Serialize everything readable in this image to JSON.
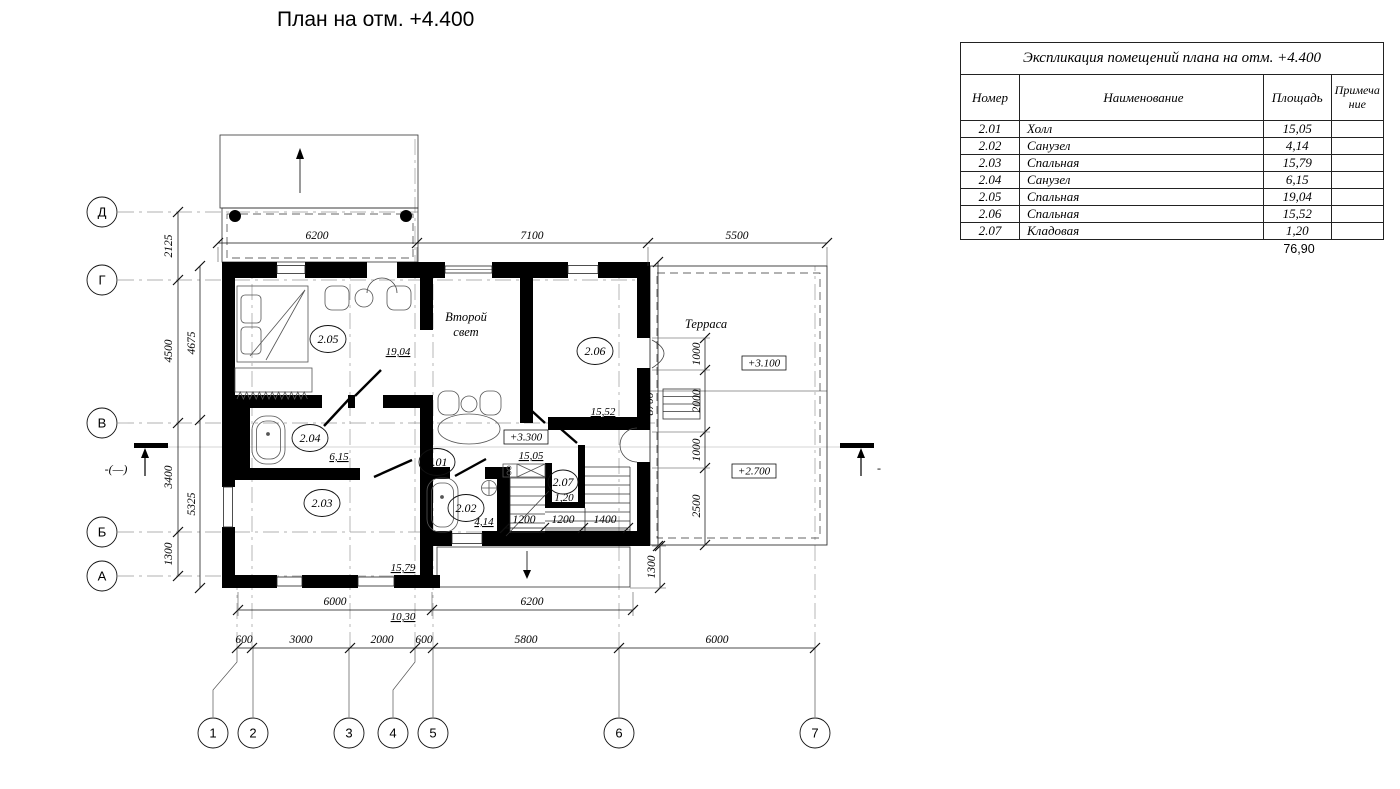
{
  "page_title": "План на отм. +4.400",
  "table": {
    "title": "Экспликация помещений плана на отм. +4.400",
    "headers": {
      "num": "Номер",
      "name": "Наименование",
      "area": "Площадь",
      "note": "Примечание"
    },
    "rows": [
      {
        "num": "2.01",
        "name": "Холл",
        "area": "15,05",
        "note": ""
      },
      {
        "num": "2.02",
        "name": "Санузел",
        "area": "4,14",
        "note": ""
      },
      {
        "num": "2.03",
        "name": "Спальная",
        "area": "15,79",
        "note": ""
      },
      {
        "num": "2.04",
        "name": "Санузел",
        "area": "6,15",
        "note": ""
      },
      {
        "num": "2.05",
        "name": "Спальная",
        "area": "19,04",
        "note": ""
      },
      {
        "num": "2.06",
        "name": "Спальная",
        "area": "15,52",
        "note": ""
      },
      {
        "num": "2.07",
        "name": "Кладовая",
        "area": "1,20",
        "note": ""
      }
    ],
    "total_area": "76,90"
  },
  "plan": {
    "axes_h": [
      "Д",
      "Г",
      "В",
      "Б",
      "А"
    ],
    "axes_v": [
      "1",
      "2",
      "3",
      "4",
      "5",
      "6",
      "7"
    ],
    "rooms": {
      "r201": {
        "num": "2.01",
        "area": "15,05"
      },
      "r202": {
        "num": "2.02",
        "area": "4,14"
      },
      "r203": {
        "num": "2.03",
        "area": "15,79"
      },
      "r204": {
        "num": "2.04",
        "area": "6,15"
      },
      "r205": {
        "num": "2.05",
        "area": "19,04"
      },
      "r206": {
        "num": "2.06",
        "area": "15,52"
      },
      "r207": {
        "num": "2.07",
        "area": "1,20"
      }
    },
    "labels": {
      "second_light_line1": "Второй",
      "second_light_line2": "свет",
      "terrace": "Терраса",
      "stair_area": "10,30"
    },
    "levels": {
      "hall": "+3.300",
      "terrace_upper": "+3.100",
      "terrace_lower": "+2.700"
    },
    "dims": {
      "top": [
        "6200",
        "7100",
        "5500"
      ],
      "left_outer": [
        "2125",
        "4500",
        "3400",
        "1300"
      ],
      "left_inner": [
        "4675",
        "5325"
      ],
      "right_chain": [
        "1000",
        "2000",
        "1000",
        "2500"
      ],
      "right_total": "8700",
      "right_porch": "1300",
      "bottom_first": [
        "6000",
        "6200"
      ],
      "bottom_second": [
        "600",
        "3000",
        "2000",
        "600",
        "5800",
        "6000"
      ],
      "stairs": [
        "1200",
        "1200",
        "1400"
      ]
    },
    "section": {
      "left_label": "-(—)",
      "right_label": "-"
    }
  }
}
